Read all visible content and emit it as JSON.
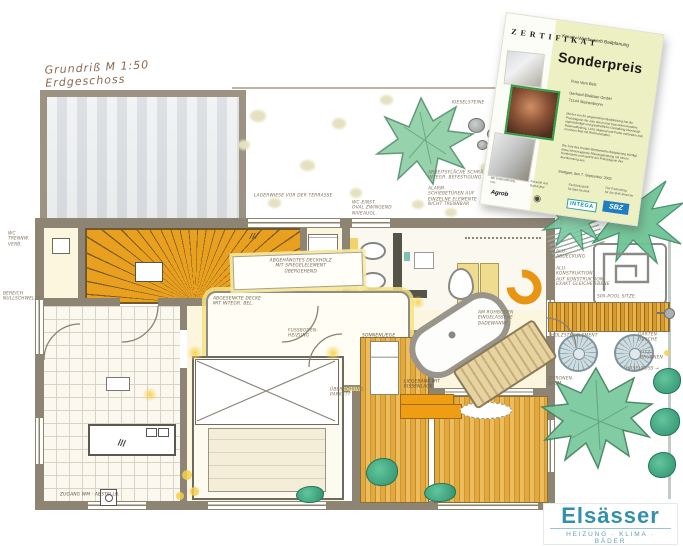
{
  "plan": {
    "title_line1": "Grundriß  M 1:50",
    "title_line2": "Erdgeschoss",
    "labels": {
      "wc": "WC\nTRENNW.\nVERB.",
      "bereich": "BEREICH\nNULLSCHWELLE",
      "garden1": "LAGERWIESE   VOR DER   TERRASSE",
      "garden2": "WC-EINST.\nOVAL ZWINGEND\nNIVEAUGL.",
      "garden3": "ARBEITSFLÄCHE  SCHRÄGUNG\nINTEGR.  BEFESTIGUNG",
      "garden4": "ALARM-\nSCHIEBETÜREN AUF\nEINZELNE ELEMENTE\nNICHT TRENNBAR",
      "kiesel": "KIESELSTEINE",
      "schrank": "///",
      "ceiling1": "ABGEHÄNGTES DECKHOLZ\nMIT SPIEGELELEMENT\nÜBERGEHEND",
      "ceiling2": "ABGESENKTE DECKE\nMIT INTEGR. BEL.",
      "fussboden": "FUSSBODEN-\nHEIZUNG",
      "parkett": "ÜBERHÖHUNG\nPARKETT",
      "sonnenliege": "SONNENLIEGE",
      "liegebank": "LIEGEBANK  MIT\nKISSENLAGE",
      "wanne": "AM ROHBODEN\nEINGELASSENE\nBADEWANNE",
      "alu1": "ALU-\nABDECKUNG",
      "alu2": "ALU-\nKONSTRUKTION\nAUF KONSTRUKTION\nEXAKT GLEICHE EBENE",
      "spapool": "SPA-POOL   SITZE",
      "holzsteg": "HOLZSTEGELEMENT",
      "dusche": "GARTEN-\nDUSCHE",
      "brunnen": "SITZ-\nBRUNNEN",
      "haselnuss": "HASELNUSS →",
      "zitrone": "ZITRONEN-\nBAUM",
      "zugang": "ZUGANG  WM  ·  ABSTELLR."
    }
  },
  "certificate": {
    "zertifikat": "Z E R T I F I K A T",
    "subtitle": "Kreativ-Wettbewerb Badplanung",
    "heading": "Sonderpreis",
    "recipient": "Frau Vera Belz",
    "company_line1": "Gerhard Elsässer GmbH",
    "company_line2": "71144 Steinenbronn",
    "body1": "Mit der von ihr eingereichten Badplanung hat die Preisträgerin die Jury durch eine besonders kreative, eigenständige und ganzheitliche Gestaltung überzeugt. Raumaufteilung, Licht, Material und Farbe verbinden sich zu einem Bad mit Wohncharakter.",
    "body2": "Die Jury des Kreativ-Wettbewerbs Badplanung würdigt diese hervorragende Planungsleistung mit einem Sonderpreis und spricht der Preisträgerin ihre Anerkennung aus.",
    "date_line": "Stuttgart, den 7. September 2002",
    "footer_cols": {
      "c1": "Mit Unterstützung\nvon:",
      "c2": "Keramik und\nBad-Kultur",
      "c3": "Fachzeitschrift\nfür Bad-Technik",
      "c4": "Der Fachverlag\nfür die SHK-Branche"
    },
    "logos": {
      "agrob": "Agrob",
      "circle": "◉",
      "intega": "INTEGA",
      "sbz": "SBZ"
    }
  },
  "brand": {
    "name": "Elsässer",
    "tagline": "HEIZUNG · KLIMA · BÄDER"
  }
}
